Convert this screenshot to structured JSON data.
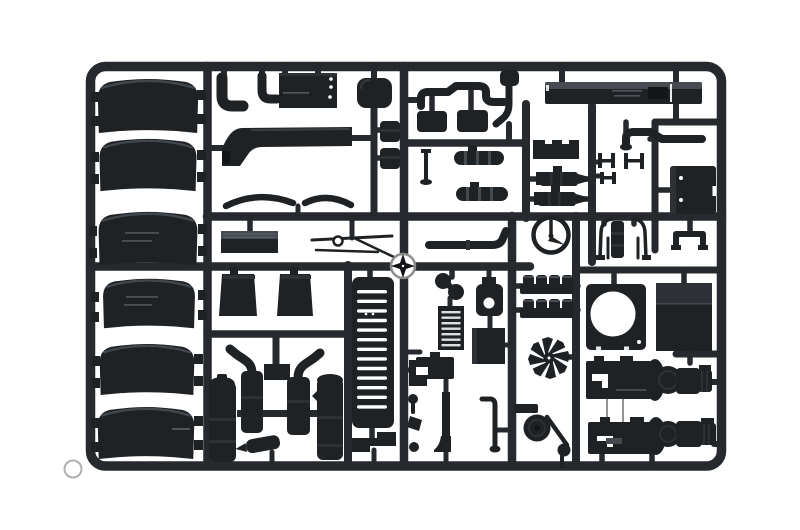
{
  "scene": {
    "type": "product-photo",
    "subject": "injection-molded plastic sprue (runner frame) of black 1/24 truck model kit parts on a white background",
    "background_color": "#ffffff"
  },
  "colors": {
    "background": "#ffffff",
    "plastic_base": "#1f2225",
    "plastic_dark": "#131518",
    "plastic_mid": "#2d3135",
    "plastic_light": "#454b51",
    "plastic_highlight": "#5c6268",
    "runner": "#26292d",
    "gate_ring": "#8d8d8d"
  },
  "parts": [
    {
      "name": "wheel-arch-fender",
      "qty": 6
    },
    {
      "name": "exhaust-elbow-pipe",
      "qty": 2
    },
    {
      "name": "roof-panel",
      "qty": 1
    },
    {
      "name": "rounded-tank",
      "qty": 1
    },
    {
      "name": "air-intake-duct",
      "qty": 1
    },
    {
      "name": "small-canister",
      "qty": 2
    },
    {
      "name": "mirror-housing",
      "qty": 2
    },
    {
      "name": "zigzag-air-line",
      "qty": 1
    },
    {
      "name": "side-sill-panel",
      "qty": 1
    },
    {
      "name": "leaf-spring",
      "qty": 2
    },
    {
      "name": "step-tread-plate",
      "qty": 1
    },
    {
      "name": "front-axle-rods",
      "qty": 1
    },
    {
      "name": "mud-flap",
      "qty": 2
    },
    {
      "name": "radiator-grille",
      "qty": 1
    },
    {
      "name": "exhaust-stack",
      "qty": 2
    },
    {
      "name": "air-reservoir-tank",
      "qty": 2
    },
    {
      "name": "small-muffler",
      "qty": 1
    },
    {
      "name": "banded-exhaust-section",
      "qty": 2
    },
    {
      "name": "air-horn",
      "qty": 1
    },
    {
      "name": "intercooler",
      "qty": 1
    },
    {
      "name": "alternator",
      "qty": 1
    },
    {
      "name": "steering-ring-gauge",
      "qty": 1
    },
    {
      "name": "air-cylinder",
      "qty": 2
    },
    {
      "name": "battery-box",
      "qty": 1
    },
    {
      "name": "pipe-clamp",
      "qty": 3
    },
    {
      "name": "tube-frame",
      "qty": 1
    },
    {
      "name": "u-bracket",
      "qty": 1
    },
    {
      "name": "cylinder-head-row",
      "qty": 2
    },
    {
      "name": "radiator-fan",
      "qty": 1
    },
    {
      "name": "fan-shroud-plate",
      "qty": 1
    },
    {
      "name": "engine-cover-panel",
      "qty": 1
    },
    {
      "name": "engine-gearbox-assembly",
      "qty": 2
    },
    {
      "name": "pulley-bracket",
      "qty": 1
    },
    {
      "name": "small-levers-and-brackets",
      "qty": 6
    },
    {
      "name": "injection-gate-marker",
      "qty": 2
    }
  ]
}
